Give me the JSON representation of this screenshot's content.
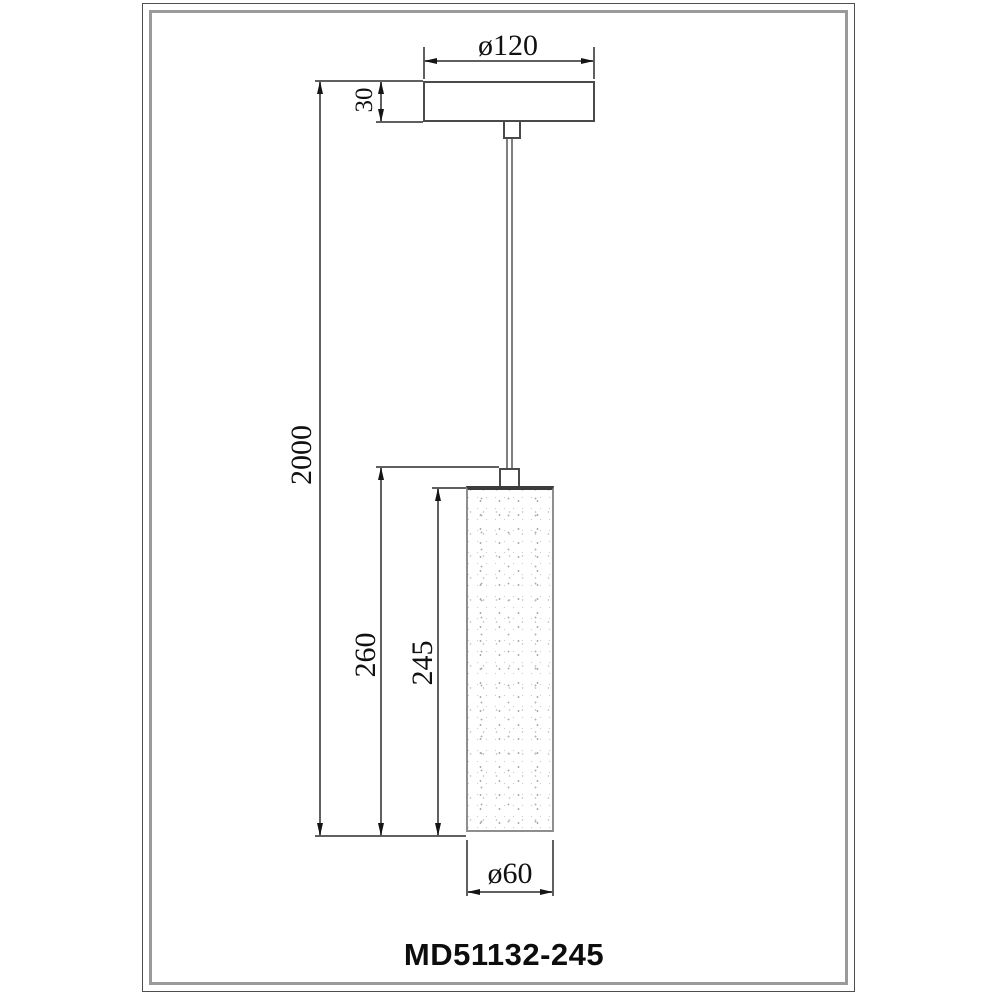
{
  "drawing": {
    "type": "technical-dimension-drawing",
    "subject": "pendant-lamp",
    "model_number": "MD51132-245",
    "dims": {
      "canopy_diameter": "ø120",
      "canopy_height": "30",
      "drop_length": "2000",
      "shade_overall_height": "260",
      "shade_body_height": "245",
      "shade_diameter": "ø60"
    },
    "colors": {
      "background": "#ffffff",
      "outline": "#4a4a4a",
      "dim_line": "#606060",
      "arrow": "#151515",
      "text": "#111111",
      "frame_outer": "#4f4f4f",
      "frame_inner": "#9a9a9a",
      "shade_top_band": "#3b3b3b"
    }
  }
}
